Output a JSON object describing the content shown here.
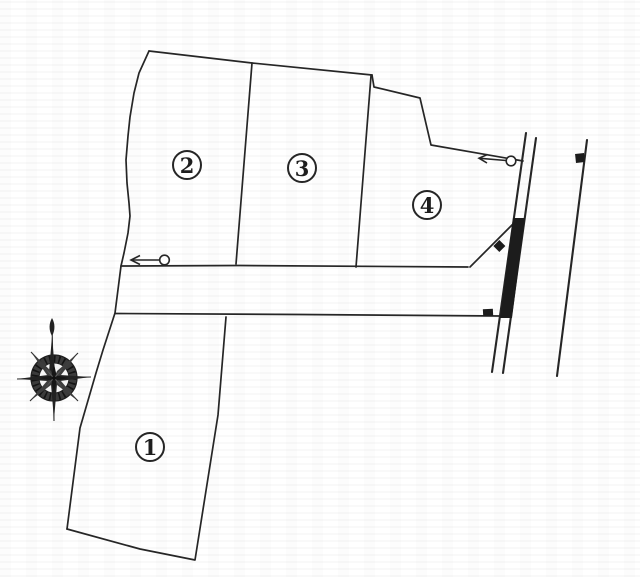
{
  "meta": {
    "diagram_type": "land-plot-layout-plan",
    "background_color": "#ffffff",
    "line_color": "#262626",
    "marker_fill_color": "#1c1c1c"
  },
  "lots": [
    {
      "id": "lot-1",
      "label": "1"
    },
    {
      "id": "lot-2",
      "label": "2"
    },
    {
      "id": "lot-3",
      "label": "3"
    },
    {
      "id": "lot-4",
      "label": "4"
    }
  ],
  "icons": {
    "compass": "compass-rose-north",
    "arrow_west": "left-arrow-with-circle-marker",
    "arrow_east": "left-arrow-with-circle-marker",
    "road_strip": "filled-road-frontage-strip",
    "square_marker_road_end": "small-square-marker",
    "square_marker_right_road": "small-square-marker",
    "diamond_marker": "small-diamond-marker"
  }
}
